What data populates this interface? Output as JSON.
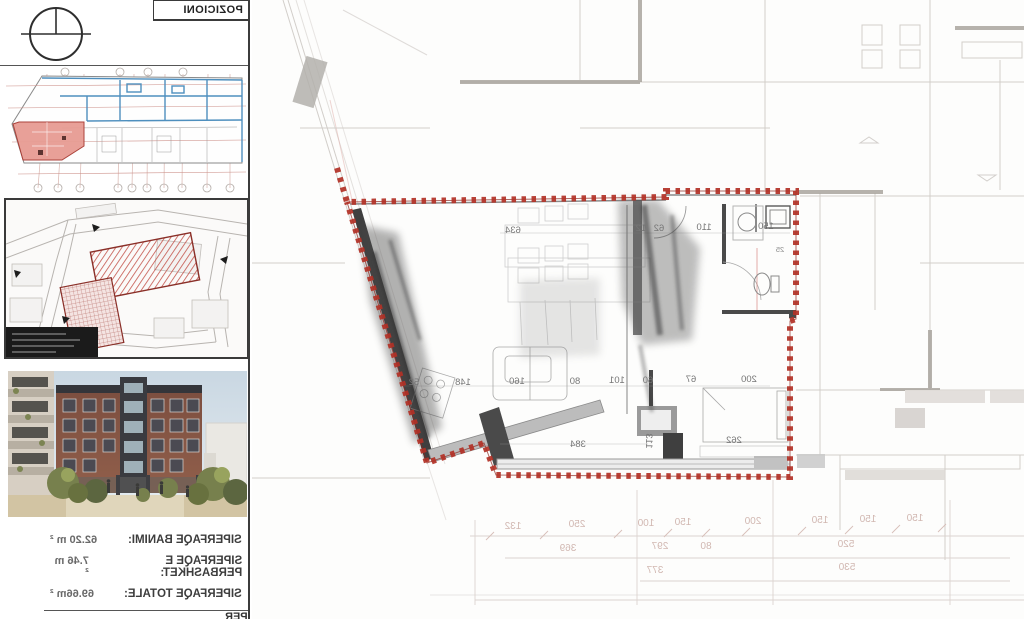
{
  "sheet": {
    "title": "POZICIONI",
    "footer_label": "PER"
  },
  "areas": {
    "rows": [
      {
        "label": "SIPERFAQE BANIMI:",
        "value": "62.20 m ²"
      },
      {
        "label": "SIPERFAQE E PERBASHKET:",
        "value": "7.46 m ²"
      },
      {
        "label": "SIPERFAQE TOTALE:",
        "value": "69.66m ²"
      }
    ]
  },
  "plan": {
    "dims_top": [
      "634",
      "12",
      "62",
      "110",
      "150",
      "25"
    ],
    "dims_mid": [
      "52",
      "148",
      "160",
      "80",
      "101",
      "60",
      "67",
      "200"
    ],
    "dims_low": [
      "384",
      "113",
      "262"
    ],
    "grid_row1": [
      "132",
      "250",
      "100",
      "150",
      "200",
      "150",
      "150",
      "150"
    ],
    "grid_row2": [
      "369",
      "297",
      "80",
      "520"
    ],
    "grid_row3": [
      "377",
      "530"
    ]
  },
  "colors": {
    "outline_red": "#b23126",
    "unit_highlight": "#e79c93",
    "wall_dark": "#454545"
  }
}
